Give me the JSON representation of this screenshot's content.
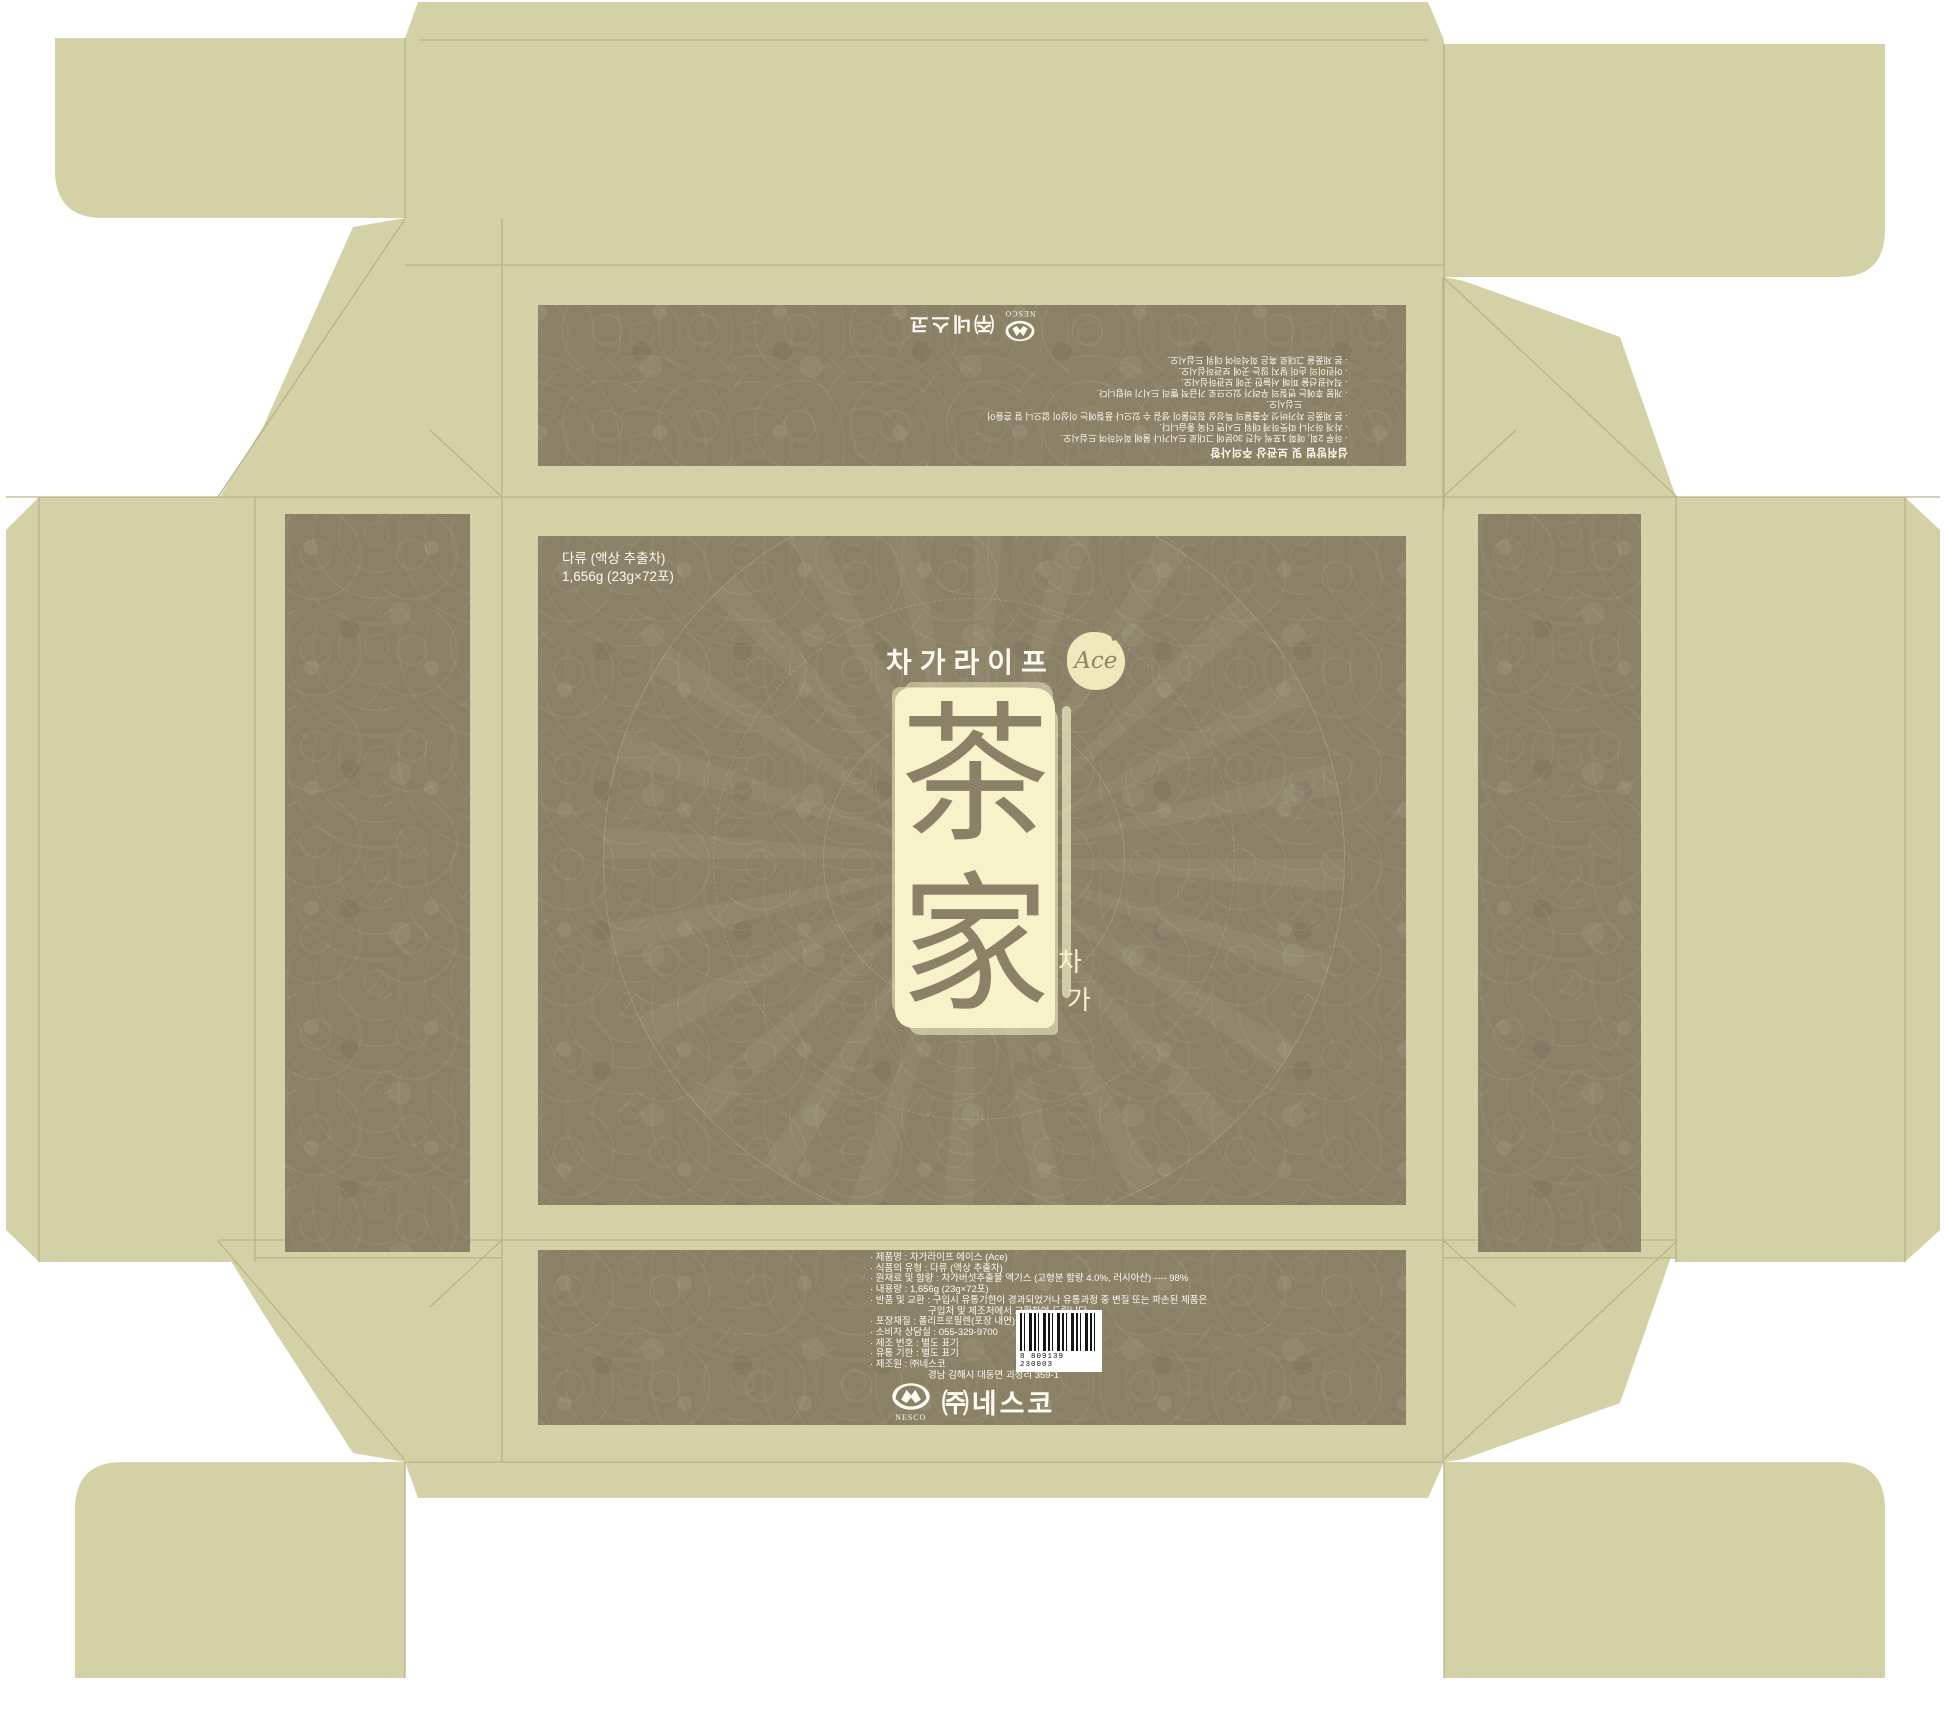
{
  "colors": {
    "flap_beige": "#d5d1a6",
    "fold_line": "#b9b38a",
    "panel_base": "#8b8167",
    "panel_pattern_highlight": "#9a9077",
    "cream_accent": "#f7f2c9",
    "text_white": "#fdfaf0",
    "logo_brown": "#8f8465"
  },
  "main_panel": {
    "category_line1": "다류 (액상 추출차)",
    "category_line2": "1,656g (23g×72포)",
    "brand": "차가라이프",
    "brand_badge": "Ace",
    "emblem_char_top": "茶",
    "emblem_char_bottom": "家",
    "side_char_top": "차",
    "side_char_bottom": "가"
  },
  "back_panel": {
    "heading": "섭취방법 및 보관상 주의사항",
    "lines": [
      "· 하루 2회, 매회 1포씩 식전 30분에 그대로 드시거나 물에 희석하여 드십시오.",
      "· 차게 하거나 따뜻하게 데워 드시면 더욱 좋습니다.",
      "· 본 제품은 차가버섯 추출물의 특성상 침전물이 생길 수 있으나 품질에는 이상이 없으니 잘 흔들어",
      "드십시오.",
      "· 개봉 후에는 변질의 우려가 있으므로 가급적 빨리 드시기 바랍니다.",
      "· 직사광선을 피해 서늘한 곳에 보관하십시오.",
      "· 어린이의 손이 닿지 않는 곳에 보관하십시오.",
      "· 본 제품을 그대로 혹은 희석하여 데워 드십시오."
    ],
    "logo_caption": "NESCO",
    "company": "㈜네스코"
  },
  "bottom_panel": {
    "info_lines": [
      "· 제품명 : 차가라이프 에이스 (Ace)",
      "· 식품의 유형 : 다류 (액상 추출차)",
      "· 원재료 및 함량 : 차가버섯추출물 엑기스 (고형분 함량 4.0%, 러시아산) ---- 98%",
      "· 내용량 : 1,656g (23g×72포)",
      "· 반품 및 교환 : 구입시 유통기한이 경과되었거나 유통과정 중 변질 또는 파손된 제품은",
      "구입처 및 제조처에서 교환하여 드립니다.",
      "· 포장재질 : 폴리프로필렌(포장 내면)",
      "· 소비자 상담실 : 055-329-9700",
      "· 제조 번호 : 별도 표기",
      "· 유통 기한 : 별도 표기",
      "· 제조원 : ㈜네스코",
      "경남 김해시 대동면 괴정리 359-1"
    ],
    "barcode_digits": "8 809139 230003",
    "logo_caption": "NESCO",
    "company": "㈜네스코"
  }
}
